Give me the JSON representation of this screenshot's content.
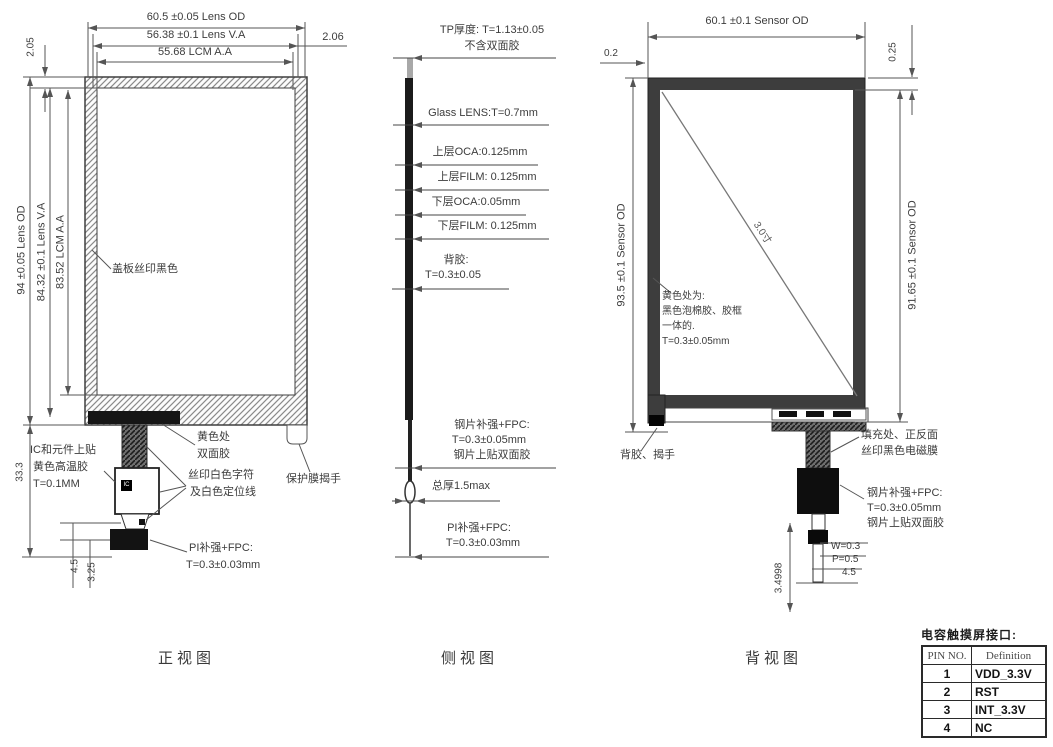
{
  "front": {
    "caption": "正视图",
    "dim_top_od": "60.5 ±0.05 Lens OD",
    "dim_top_va": "56.38 ±0.1 Lens V.A",
    "dim_top_aa": "55.68 LCM A.A",
    "dim_206": "2.06",
    "dim_205": "2.05",
    "dim_left_od": "94 ±0.05 Lens OD",
    "dim_left_va": "84.32 ±0.1 Lens V.A",
    "dim_left_aa": "83.52 LCM A.A",
    "dim_333": "33.3",
    "dim_45": "4.5",
    "dim_325": "3.25",
    "label_cover": "盖板丝印黑色",
    "label_ic_1": "IC和元件上贴",
    "label_ic_2": "黄色高温胶",
    "label_ic_3": "T=0.1MM",
    "label_yellow_1": "黄色处",
    "label_yellow_2": "双面胶",
    "label_silk_1": "丝印白色字符",
    "label_silk_2": "及白色定位线",
    "label_tab": "保护膜揭手",
    "label_pi_1": "PI补强+FPC:",
    "label_pi_2": "T=0.3±0.03mm",
    "ic_text": "IC"
  },
  "side": {
    "caption": "侧视图",
    "tp_1": "TP厚度: T=1.13±0.05",
    "tp_2": "不含双面胶",
    "glass": "Glass LENS:T=0.7mm",
    "oca_top": "上层OCA:0.125mm",
    "film_top": "上层FILM: 0.125mm",
    "oca_bot": "下层OCA:0.05mm",
    "film_bot": "下层FILM: 0.125mm",
    "glue_1": "背胶:",
    "glue_2": "T=0.3±0.05",
    "steel_1": "钢片补强+FPC:",
    "steel_2": "T=0.3±0.05mm",
    "steel_3": "钢片上贴双面胶",
    "total": "总厚1.5max",
    "pi_1": "PI补强+FPC:",
    "pi_2": "T=0.3±0.03mm"
  },
  "back": {
    "caption": "背视图",
    "dim_top": "60.1 ±0.1 Sensor OD",
    "dim_02": "0.2",
    "dim_025": "0.25",
    "dim_left": "93.5 ±0.1 Sensor OD",
    "dim_right": "91.65 ±0.1 Sensor OD",
    "diag": "3.0寸",
    "foam_1": "黄色处为:",
    "foam_2": "黑色泡棉胶、胶框",
    "foam_3": "一体的.",
    "foam_4": "T=0.3±0.05mm",
    "label_tab": "背胶、揭手",
    "fill_1": "填充处、正反面",
    "fill_2": "丝印黑色电磁膜",
    "steel_1": "钢片补强+FPC:",
    "steel_2": "T=0.3±0.05mm",
    "steel_3": "钢片上贴双面胶",
    "dim_w": "W=0.3",
    "dim_p": "P=0.5",
    "dim_45": "4.5",
    "dim_349": "3.4998"
  },
  "pin_table": {
    "title": "电容触摸屏接口:",
    "col_pin": "PIN NO.",
    "col_def": "Definition",
    "rows": [
      {
        "pin": "1",
        "def": "VDD_3.3V"
      },
      {
        "pin": "2",
        "def": "RST"
      },
      {
        "pin": "3",
        "def": "INT_3.3V"
      },
      {
        "pin": "4",
        "def": "NC"
      }
    ]
  }
}
